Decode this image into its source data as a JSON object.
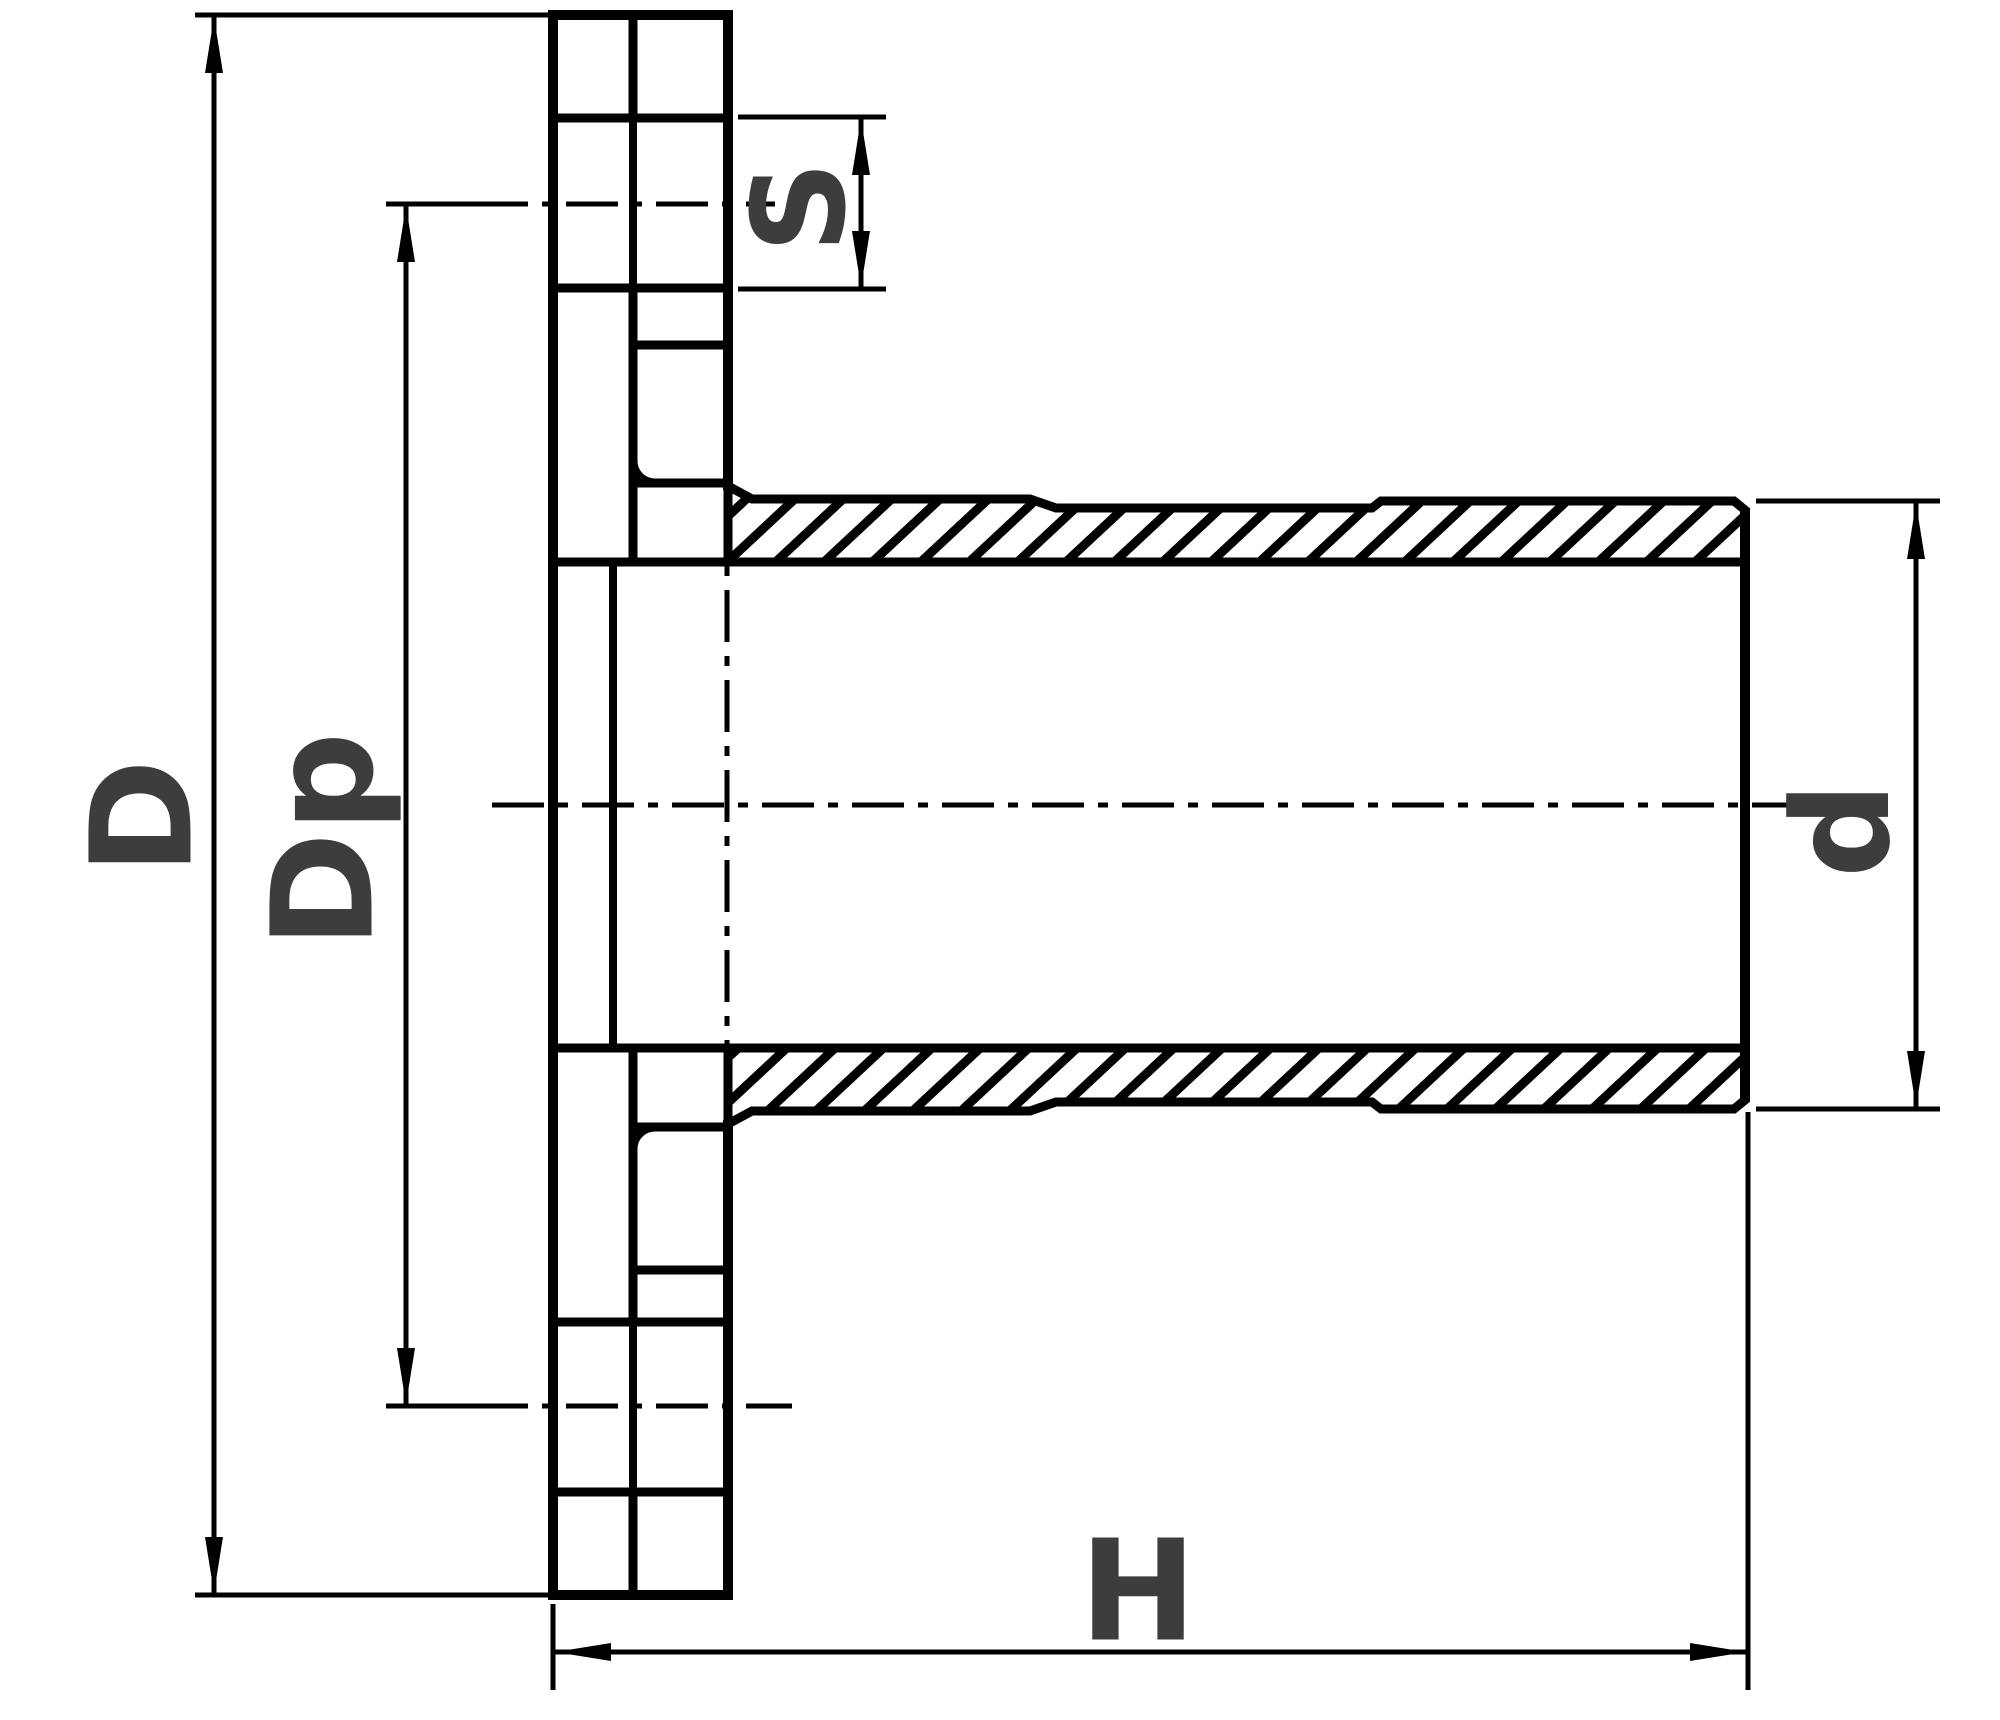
{
  "drawing": {
    "dimensions": {
      "outer_diameter": {
        "label": "D"
      },
      "bolt_circle_diameter": {
        "label": "Dp"
      },
      "bolt_hole_diameter": {
        "label": "S"
      },
      "tube_diameter": {
        "label": "d"
      },
      "overall_length": {
        "label": "H"
      }
    },
    "colors": {
      "line": "#000000",
      "label": "#3d3d3d",
      "background": "#ffffff"
    }
  }
}
